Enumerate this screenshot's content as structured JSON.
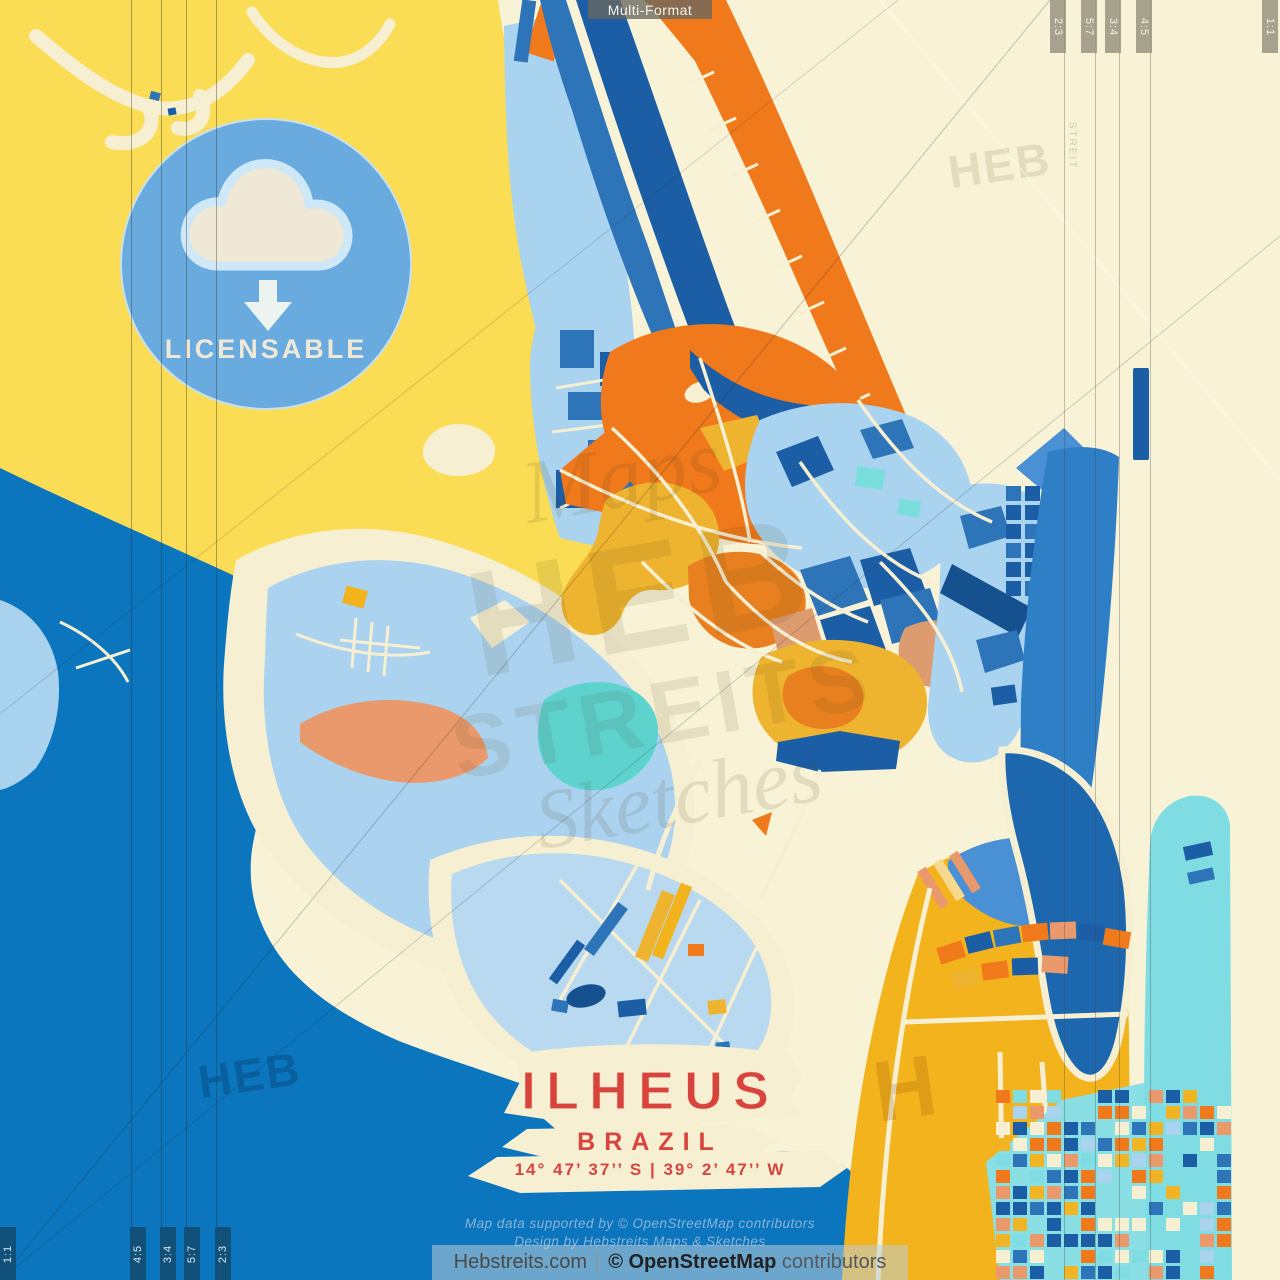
{
  "header": {
    "format_label": "Multi-Format"
  },
  "badge": {
    "label": "LICENSABLE"
  },
  "ratios": {
    "top": [
      "2:3",
      "5:7",
      "3:4",
      "4:5",
      "1:1"
    ],
    "bottom": [
      "1:1",
      "4:5",
      "3:4",
      "5:7",
      "2:3"
    ]
  },
  "title_block": {
    "city": "ILHEUS",
    "country": "BRAZIL",
    "coordinates": "14° 47’ 37’’ S | 39° 2’ 47’’ W"
  },
  "credits": {
    "line1": "Map data supported by © OpenStreetMap contributors",
    "line2": "Design by Hebstreits Maps & Sketches"
  },
  "footer": {
    "site": "Hebstreits.com",
    "separator": "|",
    "osm_bold": "© OpenStreetMap",
    "contributors": "contributors"
  },
  "watermarks": {
    "center_script_top": "Maps",
    "center_main": "HEB",
    "center_sub": "STREITS",
    "center_script_bottom": "Sketches",
    "corner": "HEB",
    "corner_small": "STREIT",
    "corner_single": "H"
  },
  "palette": {
    "background_cream": "#F8F2D6",
    "land_yellow": "#FADC55",
    "water_deep_blue": "#0B76BE",
    "water_light_blue": "#ABD3EF",
    "ocean_blue": "#2E7FC6",
    "block_dark_blue": "#1B5EA6",
    "block_mid_blue": "#2E74B8",
    "block_orange": "#F0791C",
    "block_gold": "#F1B425",
    "block_salmon": "#E9996B",
    "turquoise": "#7EDCE2",
    "title_red": "#D8443C",
    "badge_blue": "#69ABDE"
  }
}
